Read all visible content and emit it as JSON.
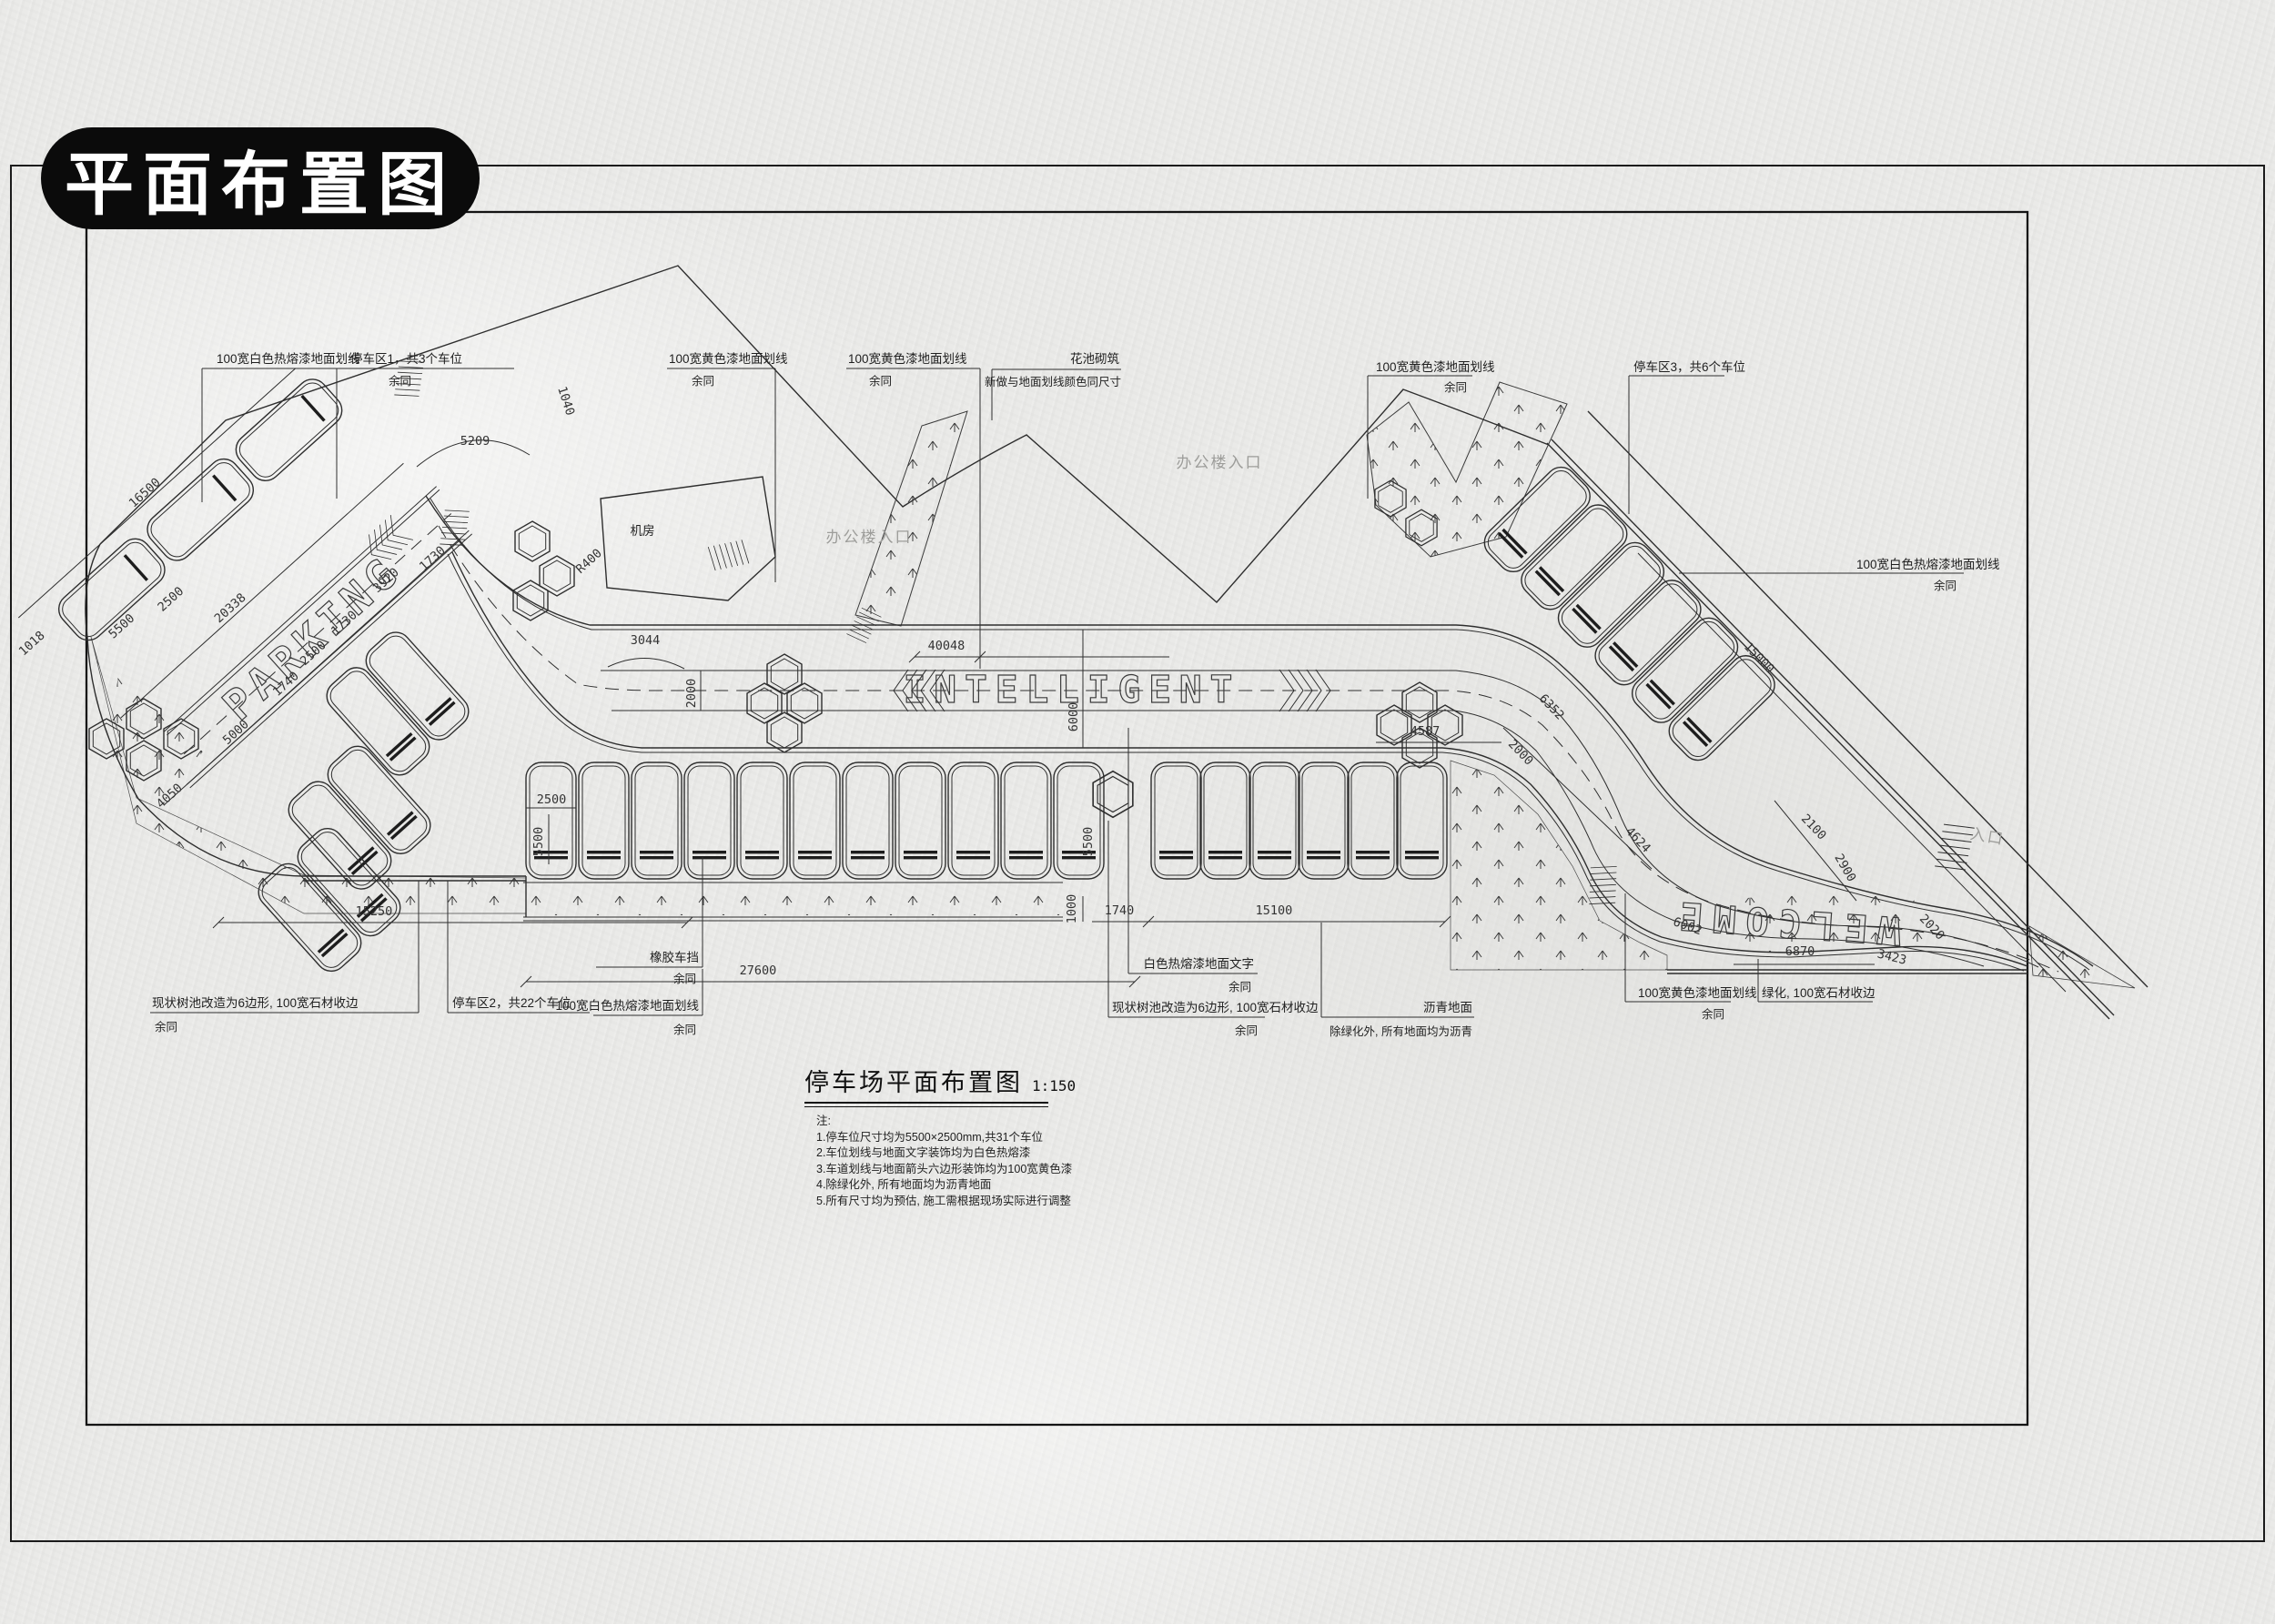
{
  "badge": {
    "title": "平面布置图"
  },
  "title_block": {
    "title": "停车场平面布置图",
    "scale": "1:150"
  },
  "notes": {
    "label": "注:",
    "items": [
      "1.停车位尺寸均为5500×2500mm,共31个车位",
      "2.车位划线与地面文字装饰均为白色热熔漆",
      "3.车道划线与地面箭头六边形装饰均为100宽黄色漆",
      "4.除绿化外, 所有地面均为沥青地面",
      "5.所有尺寸均为预估, 施工需根据现场实际进行调整"
    ]
  },
  "road_text": {
    "parking": "PARKING",
    "intelligent": "INTELLIGENT",
    "welcome": "WELCOME"
  },
  "area_labels": {
    "office_entrance": "办公楼入口",
    "entrance": "入口",
    "building": "机房"
  },
  "callouts": {
    "white_line": "100宽白色热熔漆地面划线",
    "yellow_line": "100宽黄色漆地面划线",
    "same_rest": "余同",
    "zone1": "停车区1，共3个车位",
    "zone2": "停车区2，共22个车位",
    "zone3": "停车区3，共6个车位",
    "flower_bed": "花池砌筑",
    "flower_bed_sub": "新做与地面划线颜色同尺寸",
    "tree_pit": "现状树池改造为6边形, 100宽石材收边",
    "wheel_stop": "橡胶车挡",
    "road_text_note": "白色热熔漆地面文字",
    "asphalt": "沥青地面",
    "asphalt_sub": "除绿化外, 所有地面均为沥青",
    "green_edge": "绿化, 100宽石材收边"
  },
  "dims": {
    "d1018": "1018",
    "d16500": "16500",
    "d5500": "5500",
    "d2500": "2500",
    "d20338": "20338",
    "d5209": "5209",
    "d1040": "1040",
    "d1730": "1730",
    "d3920": "3920",
    "d1740": "1740",
    "d5000": "5000",
    "d4050": "4050",
    "dR400": "R400",
    "d3044": "3044",
    "d2000": "2000",
    "d40048": "40048",
    "d6000": "6000",
    "d27600": "27600",
    "d15250": "15250",
    "d1000": "1000",
    "d15100": "15100",
    "d4587": "4587",
    "d15000": "15000",
    "d6352": "6352",
    "d4624": "4624",
    "d2100": "2100",
    "d2900": "2900",
    "d6002": "6002",
    "d6870": "6870",
    "d3423": "3423",
    "d2020": "2020"
  }
}
